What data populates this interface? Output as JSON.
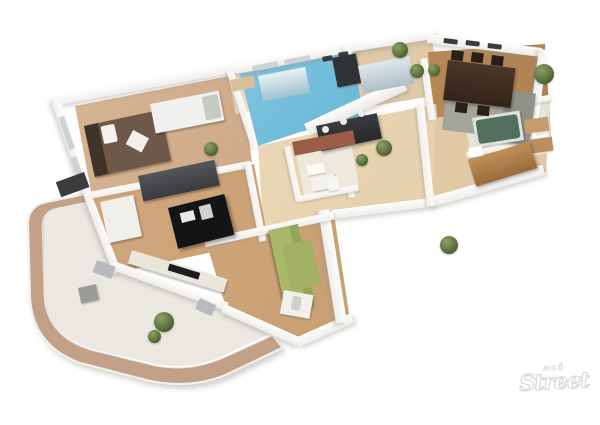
{
  "meta": {
    "description": "3D isometric cutaway render of a furnished apartment floor plan with a large curved balcony terrace, white walls, wood floors, blue-tiled kitchen and a faint logo watermark in the lower right corner",
    "background_color": "#ffffff"
  },
  "watermark": {
    "top_text": "мой",
    "main_text": "Street"
  },
  "palette": {
    "wall": "#f8f6f2",
    "wood_floor_bedroom": "#cfa883",
    "wood_floor_living": "#cfa77d",
    "wood_floor_dining": "#b98b5f",
    "wood_floor_hall": "#e6d2b0",
    "kitchen_floor_blue": "#5fb3d4",
    "balcony_band": "#c3a088",
    "balcony_floor": "#ebe8e1",
    "green_sofa": "#a9b96a",
    "bed_brown": "#6e5849",
    "dark_wardrobe": "#3b3c3e",
    "black_desk": "#141416",
    "bathtub_green": "#53705f",
    "cabinet_brown": "#b8854f",
    "tile_brown": "#9a5e48",
    "plant_green": "#5c7340"
  },
  "rooms": [
    {
      "id": "bedroom",
      "label": "Bedroom"
    },
    {
      "id": "kitchen",
      "label": "Kitchen"
    },
    {
      "id": "entry",
      "label": "Entry hall"
    },
    {
      "id": "dining-room",
      "label": "Dining room"
    },
    {
      "id": "hallway",
      "label": "Hallway"
    },
    {
      "id": "inner-bathroom",
      "label": "Bathroom"
    },
    {
      "id": "right-bathroom",
      "label": "Bathroom with tub"
    },
    {
      "id": "living-room",
      "label": "Living room"
    },
    {
      "id": "lounge",
      "label": "Lounge with green sofa"
    },
    {
      "id": "balcony",
      "label": "Curved balcony terrace"
    }
  ],
  "furniture": [
    "double bed",
    "white daybed",
    "dark sideboard",
    "black desk",
    "white cabinet",
    "tv console",
    "green corner sofa",
    "white side table with lamp",
    "dark wardrobe console",
    "small hall table",
    "bar counter with stools",
    "kitchen cabinets",
    "refrigerator",
    "dining table with chairs",
    "gray dining sofa",
    "area rug",
    "green bathtub",
    "wash basin",
    "wooden shelves",
    "brown cabinet",
    "toilet",
    "balcony planter box",
    "potted plants"
  ]
}
